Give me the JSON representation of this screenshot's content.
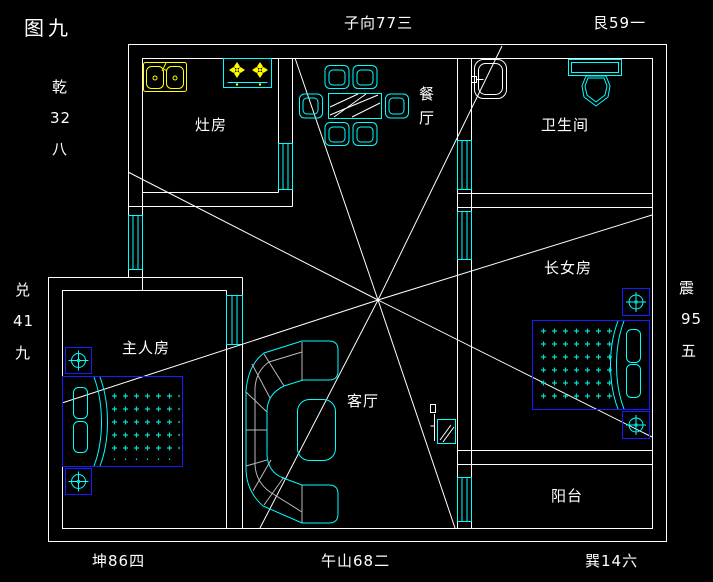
{
  "figure_title": "图九",
  "compass": {
    "top_center": "子向77三",
    "top_right": "艮59一",
    "left_upper": [
      "乾",
      "32",
      "八"
    ],
    "left_lower": [
      "兑",
      "41",
      "九"
    ],
    "right_side": [
      "震",
      "95",
      "五"
    ],
    "bottom_left": "坤86四",
    "bottom_center": "午山68二",
    "bottom_right": "巽14六"
  },
  "rooms": {
    "kitchen": "灶房",
    "dining": "餐厅",
    "bathroom": "卫生间",
    "eldest_daughter": "长女房",
    "master": "主人房",
    "living": "客厅",
    "balcony": "阳台"
  },
  "colors": {
    "background": "#000000",
    "walls_text": "#ffffff",
    "furniture_cyan": "#00ffff",
    "fixture_yellow": "#ffff00",
    "bed_frame_blue": "#1a1aff",
    "mattress_dots": "#00ddc8",
    "sofa_detail_gray": "#b9b9b9"
  }
}
